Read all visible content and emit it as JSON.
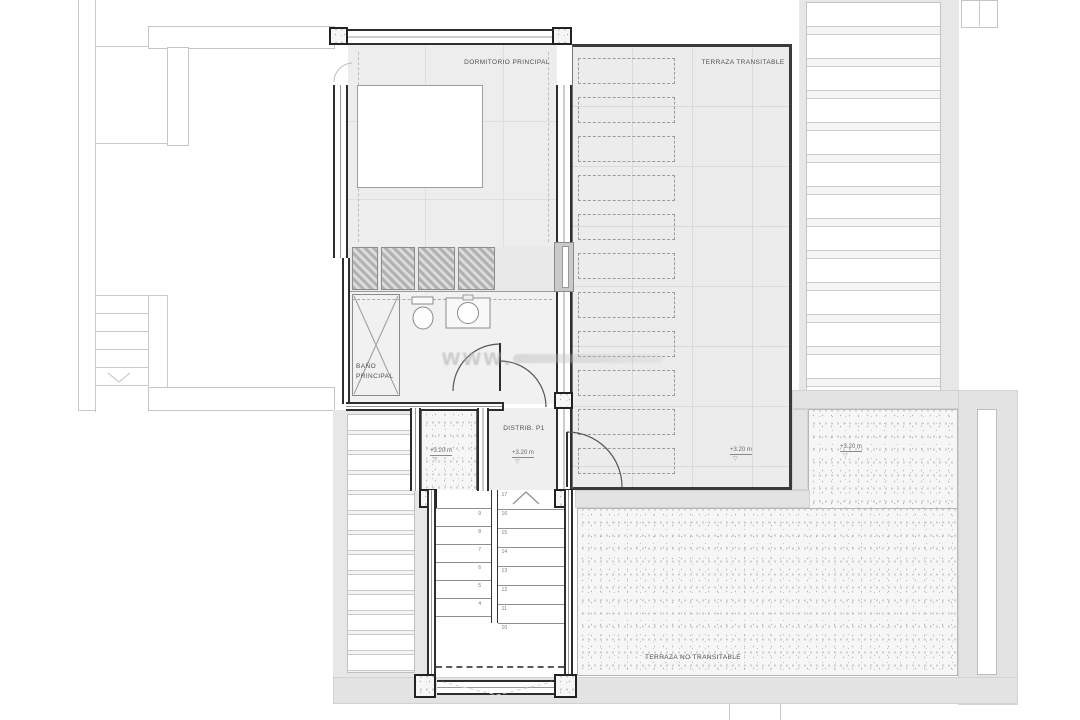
{
  "labels": {
    "bedroom": "DORMITORIO PRINCIPAL",
    "terrace_walkable": "TERRAZA TRANSITABLE",
    "bathroom_line1": "BAÑO",
    "bathroom_line2": "PRINCIPAL",
    "distributor": "DISTRIB. P1",
    "terrace_non_walkable": "TERRAZA NO TRANSITABLE"
  },
  "levels": {
    "shaft": "+3.20 m",
    "distributor": "+3.20 m",
    "terrace_walkable": "+3.20 m",
    "terrace_non_walkable": "+3.20 m"
  },
  "watermark": "www.",
  "stairs": {
    "left_flight_numbers": [
      "9",
      "8",
      "7",
      "6",
      "5",
      "4"
    ],
    "right_flight_numbers": [
      "17",
      "16",
      "15",
      "14",
      "13",
      "12",
      "11",
      "10"
    ]
  },
  "terrace": {
    "plank_count": 11
  },
  "colors": {
    "wall": "#2e2e2e",
    "room_fill": "#ececec",
    "band_fill": "#e3e3e3",
    "faint_line": "#c9c9c9"
  }
}
